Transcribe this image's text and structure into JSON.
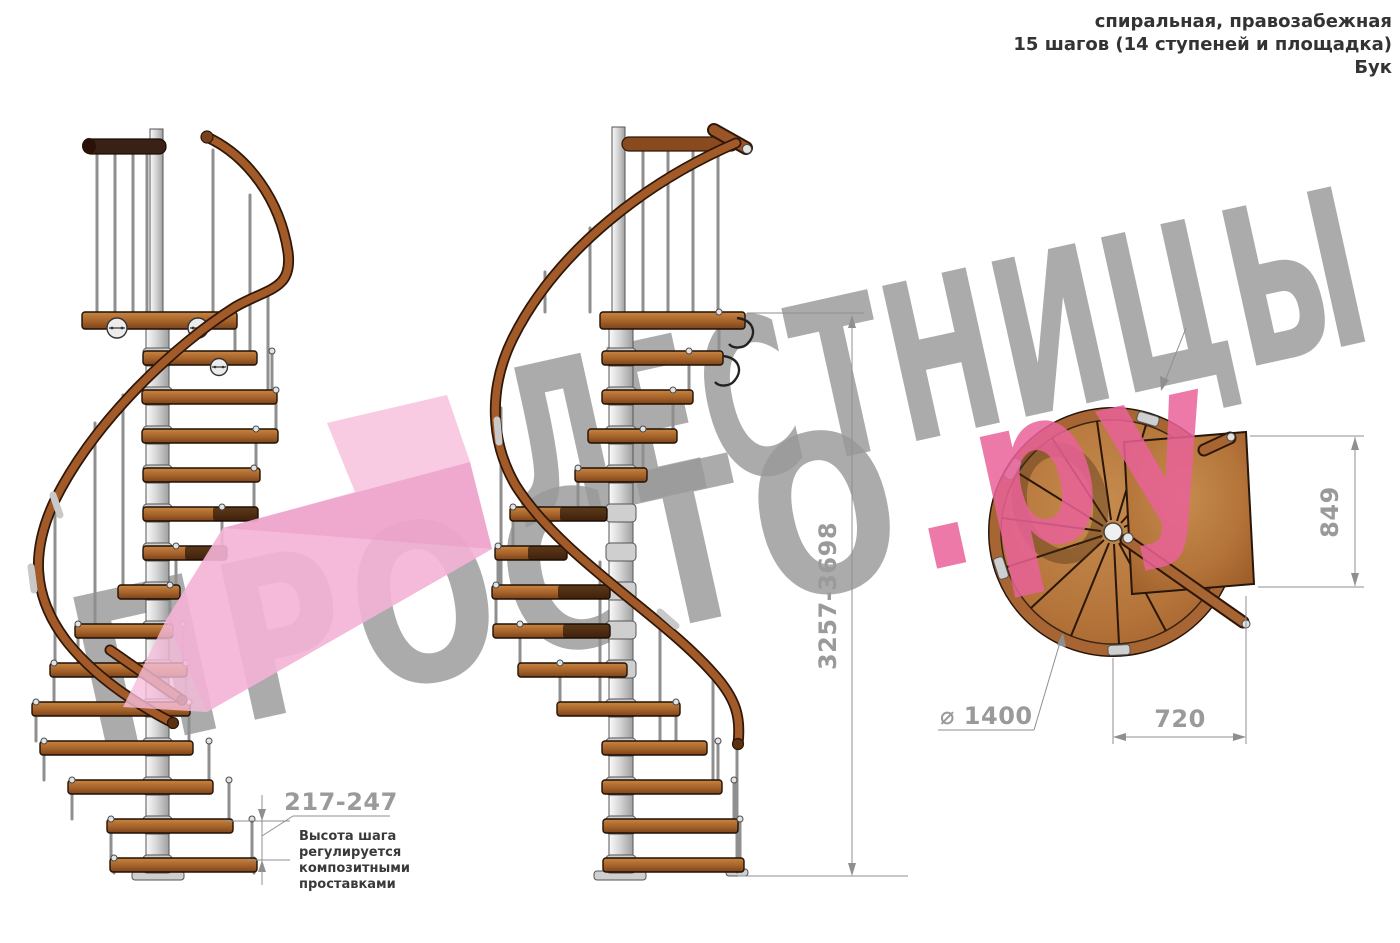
{
  "title_block": {
    "line1": "спиральная, правозабежная",
    "line2": "15 шагов (14 ступеней и площадка)",
    "line3": "Бук"
  },
  "watermark": {
    "line1": "ЛЕСТНИЦЫ",
    "line2": "ПРОСТО",
    "suffix": ".ру",
    "gray_color": "#989898",
    "pink_color": "#e96299"
  },
  "dimensions": {
    "total_height": "3257-3698",
    "platform_depth": "849",
    "platform_width": "720",
    "diameter": "⌀ 1400",
    "step_height": "217-247"
  },
  "step_note": {
    "line1": "Высота шага",
    "line2": "регулируется",
    "line3": "композитными",
    "line4": "проставками"
  },
  "colors": {
    "wood": "#a9622b",
    "rail": "#a15a28",
    "dark_rail": "#3a2115",
    "steel": "#d6d6d6",
    "dim": "#9a9a9a",
    "pink_arrow": "#f6bedb"
  }
}
